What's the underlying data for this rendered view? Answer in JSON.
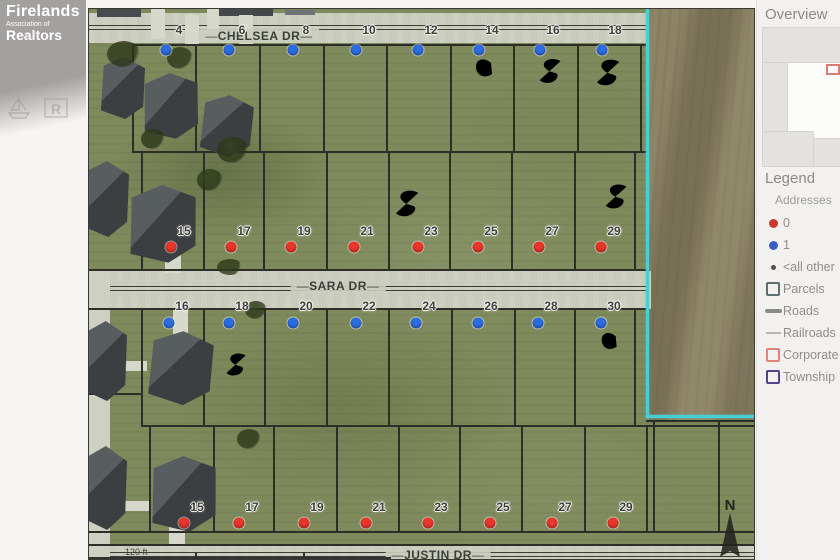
{
  "watermark": {
    "line1": "Firelands",
    "line2": "Association of",
    "line3": "Realtors"
  },
  "sidebar": {
    "overview_title": "Overview",
    "legend_title": "Legend",
    "addresses_label": "Addresses",
    "legend_items": [
      {
        "name": "addresses-0",
        "swatch": "dot",
        "color": "#c63a2f",
        "label": "0"
      },
      {
        "name": "addresses-1",
        "swatch": "dot",
        "color": "#3a60c4",
        "label": "1"
      },
      {
        "name": "addresses-all-other",
        "swatch": "dot-small",
        "color": "#515150",
        "label": "<all other"
      },
      {
        "name": "parcels",
        "swatch": "square",
        "color": "#5d6f6f",
        "label": "Parcels"
      },
      {
        "name": "roads",
        "swatch": "line-thick",
        "color": "#8a8a88",
        "label": "Roads"
      },
      {
        "name": "railroads",
        "swatch": "line-thin",
        "color": "#b7b7b5",
        "label": "Railroads"
      },
      {
        "name": "corporate",
        "swatch": "square",
        "color": "#e2837b",
        "label": "Corporate"
      },
      {
        "name": "township",
        "swatch": "square",
        "color": "#51458a",
        "label": "Township"
      }
    ]
  },
  "map": {
    "streets": [
      {
        "name": "CHELSEA DR",
        "cx": 170,
        "cy": 27
      },
      {
        "name": "SARA DR",
        "cx": 249,
        "cy": 277
      },
      {
        "name": "JUSTIN DR",
        "cx": 349,
        "cy": 546
      }
    ],
    "scale_label": "120 ft",
    "north_label": "N",
    "boundary_color": "#48cfd4",
    "dot_colors": {
      "blue": "#2d6cdf",
      "red": "#e8362a"
    },
    "lot_rows": [
      {
        "dot": "blue",
        "label_y": 21,
        "dot_y": 41,
        "lots": [
          {
            "n": "4",
            "x": 77
          },
          {
            "n": "6",
            "x": 140
          },
          {
            "n": "8",
            "x": 204
          },
          {
            "n": "10",
            "x": 267
          },
          {
            "n": "12",
            "x": 329
          },
          {
            "n": "14",
            "x": 390
          },
          {
            "n": "16",
            "x": 451
          },
          {
            "n": "18",
            "x": 513
          }
        ]
      },
      {
        "dot": "red",
        "label_y": 222,
        "dot_y": 238,
        "lots": [
          {
            "n": "15",
            "x": 82
          },
          {
            "n": "17",
            "x": 142
          },
          {
            "n": "19",
            "x": 202
          },
          {
            "n": "21",
            "x": 265
          },
          {
            "n": "23",
            "x": 329
          },
          {
            "n": "25",
            "x": 389
          },
          {
            "n": "27",
            "x": 450
          },
          {
            "n": "29",
            "x": 512
          }
        ]
      },
      {
        "dot": "blue",
        "label_y": 297,
        "dot_y": 314,
        "lots": [
          {
            "n": "16",
            "x": 80
          },
          {
            "n": "18",
            "x": 140
          },
          {
            "n": "20",
            "x": 204
          },
          {
            "n": "22",
            "x": 267
          },
          {
            "n": "24",
            "x": 327
          },
          {
            "n": "26",
            "x": 389
          },
          {
            "n": "28",
            "x": 449
          },
          {
            "n": "30",
            "x": 512
          }
        ]
      },
      {
        "dot": "red",
        "label_y": 498,
        "dot_y": 514,
        "lots": [
          {
            "n": "15",
            "x": 95
          },
          {
            "n": "17",
            "x": 150
          },
          {
            "n": "19",
            "x": 215
          },
          {
            "n": "21",
            "x": 277
          },
          {
            "n": "23",
            "x": 339
          },
          {
            "n": "25",
            "x": 401
          },
          {
            "n": "27",
            "x": 463
          },
          {
            "n": "29",
            "x": 524
          }
        ]
      }
    ],
    "annotations": [
      {
        "glyph": "IC",
        "x": 360,
        "y": 45,
        "w": 46,
        "h": 30
      },
      {
        "glyph": "S",
        "x": 447,
        "y": 46,
        "w": 27,
        "h": 32
      },
      {
        "glyph": "S",
        "x": 504,
        "y": 48,
        "w": 29,
        "h": 31
      },
      {
        "glyph": "S",
        "x": 513,
        "y": 172,
        "w": 27,
        "h": 31
      },
      {
        "glyph": "S",
        "x": 303,
        "y": 178,
        "w": 29,
        "h": 33
      },
      {
        "glyph": "S",
        "x": 134,
        "y": 339,
        "w": 25,
        "h": 33
      },
      {
        "glyph": "IC",
        "x": 486,
        "y": 319,
        "w": 46,
        "h": 28
      }
    ]
  }
}
